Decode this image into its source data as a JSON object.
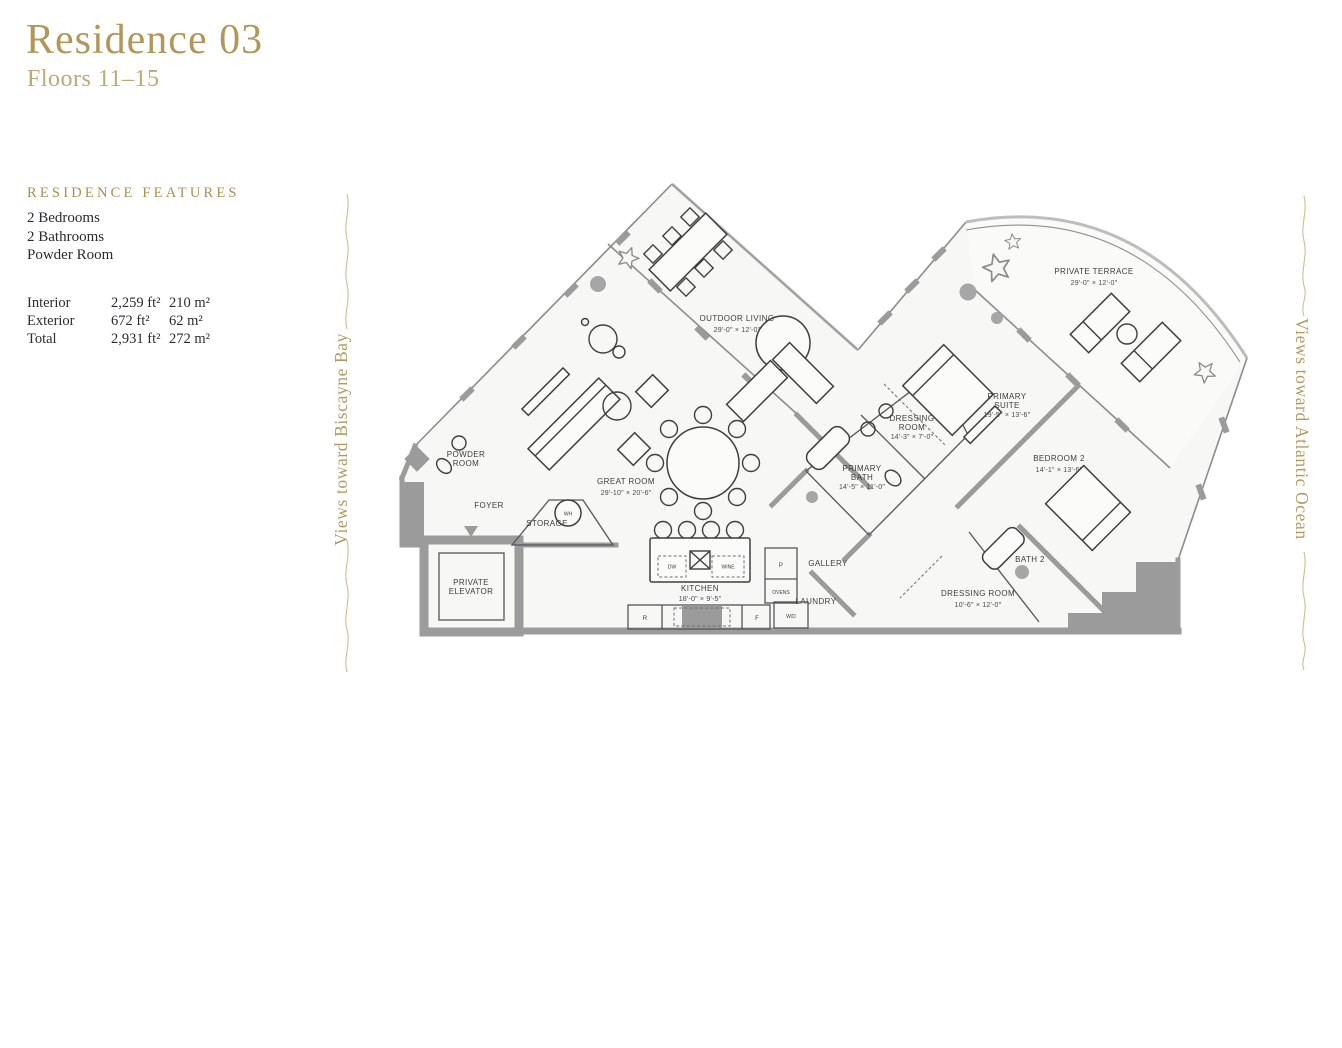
{
  "page": {
    "background": "#ffffff",
    "accent_gold": "#b2965a",
    "wall_gray": "#9b9b9b",
    "line_dark": "#3f3f41",
    "text_dark": "#2c2c30"
  },
  "header": {
    "title": "Residence 03",
    "subtitle": "Floors 11–15"
  },
  "features": {
    "heading": "RESIDENCE FEATURES",
    "items": [
      "2 Bedrooms",
      "2 Bathrooms",
      "Powder Room"
    ]
  },
  "areas": {
    "rows": [
      {
        "label": "Interior",
        "imperial": "2,259 ft²",
        "metric": "210 m²"
      },
      {
        "label": "Exterior",
        "imperial": "672 ft²",
        "metric": "62 m²"
      },
      {
        "label": "Total",
        "imperial": "2,931 ft²",
        "metric": "272 m²"
      }
    ]
  },
  "side_labels": {
    "left": "Views toward Biscayne Bay",
    "right": "Views toward Atlantic Ocean"
  },
  "floorplan": {
    "rooms": [
      {
        "label": "OUTDOOR LIVING",
        "dims": "29'-0\" × 12'-0\""
      },
      {
        "label": "PRIVATE TERRACE",
        "dims": "29'-0\" × 12'-0\""
      },
      {
        "label": "GREAT ROOM",
        "dims": "29'-10\" × 20'-6\""
      },
      {
        "label": "KITCHEN",
        "dims": "18'-0\" × 9'-5\""
      },
      {
        "label": "POWDER",
        "label2": "ROOM"
      },
      {
        "label": "FOYER"
      },
      {
        "label": "STORAGE"
      },
      {
        "label": "PRIVATE",
        "label2": "ELEVATOR"
      },
      {
        "label": "PRIMARY",
        "label2": "BATH",
        "dims": "14'-5\" × 11'-0\""
      },
      {
        "label": "DRESSING",
        "label2": "ROOM",
        "dims": "14'-3\" × 7'-0\""
      },
      {
        "label": "PRIMARY",
        "label2": "SUITE",
        "dims": "19'-5\" × 13'-6\""
      },
      {
        "label": "BEDROOM 2",
        "dims": "14'-1\" × 13'-6\""
      },
      {
        "label": "BATH 2"
      },
      {
        "label": "DRESSING ROOM",
        "dims": "10'-6\" × 12'-0\""
      },
      {
        "label": "GALLERY"
      },
      {
        "label": "LAUNDRY"
      }
    ],
    "appliances": {
      "dw": "DW",
      "wine": "WINE",
      "pantry": "P",
      "ovens": "OVENS",
      "range": "R",
      "fridge": "F",
      "washer_dryer": "W/D",
      "water_heater": "WH"
    }
  }
}
